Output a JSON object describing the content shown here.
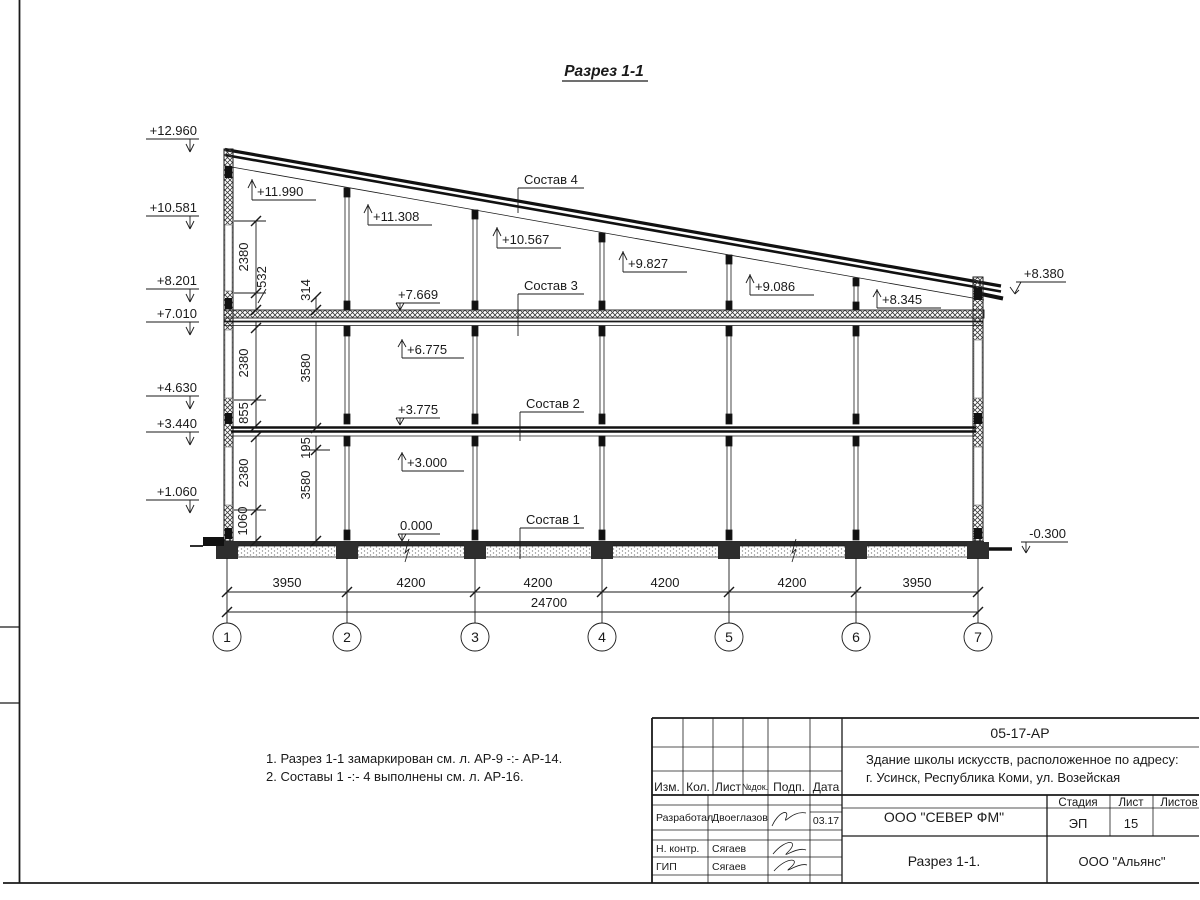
{
  "sheet": {
    "title": "Разрез 1-1",
    "notes": [
      "1. Разрез 1-1 замаркирован см. л. АР-9 -:- АР-14.",
      "2. Составы 1 -:- 4 выполнены см. л. АР-16."
    ]
  },
  "levels": {
    "left": [
      "+12.960",
      "+10.581",
      "+8.201",
      "+7.010",
      "+4.630",
      "+3.440",
      "+1.060"
    ],
    "roof": [
      "+11.990",
      "+11.308",
      "+10.567",
      "+9.827",
      "+9.086",
      "+8.345"
    ],
    "floors_up": [
      "+6.775",
      "+3.000"
    ],
    "floors_down": [
      "+7.669",
      "+3.775",
      "0.000"
    ],
    "right_top": "+8.380",
    "right_bottom": "-0.300"
  },
  "layers": {
    "c4": "Состав 4",
    "c3": "Состав 3",
    "c2": "Состав 2",
    "c1": "Состав 1"
  },
  "dims": {
    "chain_a": [
      "2380",
      "532",
      "2380",
      "855",
      "2380",
      "1060"
    ],
    "chain_b": [
      "314",
      "3580",
      "195",
      "3580"
    ],
    "spans": [
      "3950",
      "4200",
      "4200",
      "4200",
      "4200",
      "3950"
    ],
    "total": "24700"
  },
  "axes": [
    "1",
    "2",
    "3",
    "4",
    "5",
    "6",
    "7"
  ],
  "titleblock": {
    "doc_number": "05-17-АР",
    "object_line1": "Здание школы искусств, расположенное по адресу:",
    "object_line2": "г. Усинск, Республика Коми, ул. Возейская",
    "cols": [
      "Изм.",
      "Кол.",
      "Лист",
      "№док.",
      "Подп.",
      "Дата"
    ],
    "roles": {
      "developer_label": "Разработал",
      "developer_name": "Двоеглазов",
      "developer_date": "03.17",
      "ncontrol_label": "Н. контр.",
      "ncontrol_name": "Сягаев",
      "gip_label": "ГИП",
      "gip_name": "Сягаев"
    },
    "company": "ООО \"СЕВЕР ФМ\"",
    "drawing_title": "Разрез 1-1.",
    "stage_label": "Стадия",
    "stage_value": "ЭП",
    "sheet_label": "Лист",
    "sheet_value": "15",
    "sheets_label": "Листов",
    "contractor": "ООО \"Альянс\""
  }
}
